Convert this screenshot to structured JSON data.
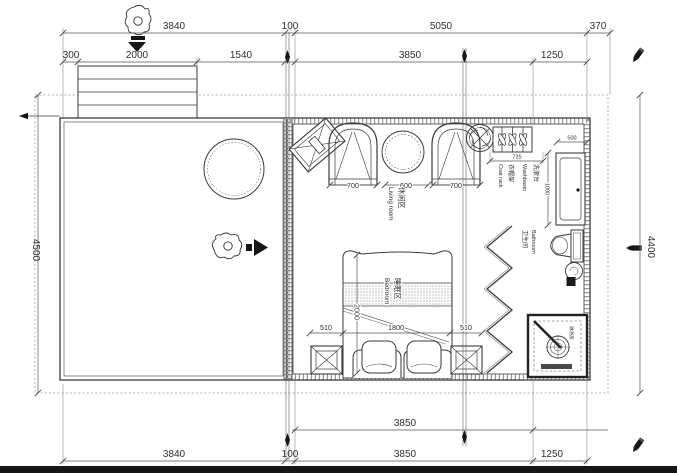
{
  "colors": {
    "line": "#3b3b3b",
    "hatch": "#9a9a9a",
    "ink": "#161616",
    "boundary": "#999999"
  },
  "dims": {
    "top1": [
      "3840",
      "100",
      "5050",
      "370"
    ],
    "top2": [
      "300",
      "2000",
      "1540",
      "3850",
      "1250"
    ],
    "left": "4500",
    "right": "4400",
    "bottom_inner": "3850",
    "bottom": [
      "3840",
      "100",
      "3850",
      "1250"
    ],
    "living": [
      "700",
      "600",
      "700"
    ],
    "bed_row": [
      "510",
      "1800",
      "510"
    ],
    "bed_length": "2000",
    "coat_rack": "725",
    "washbasin_width": "500",
    "washbasin_depth": "1000"
  },
  "rooms": {
    "living_zh": "休闲区",
    "living_en": "Living room",
    "bedroom_zh": "睡眠区",
    "bedroom_en": "Bedroom",
    "bathroom_zh": "卫生间",
    "bathroom_en": "Bathroom",
    "washbasin_zh": "洗漱台",
    "washbasin_en": "Washbasin",
    "coatrack_zh": "衣帽架",
    "coatrack_en": "Coat rack",
    "shower_zh": "淋浴房"
  }
}
